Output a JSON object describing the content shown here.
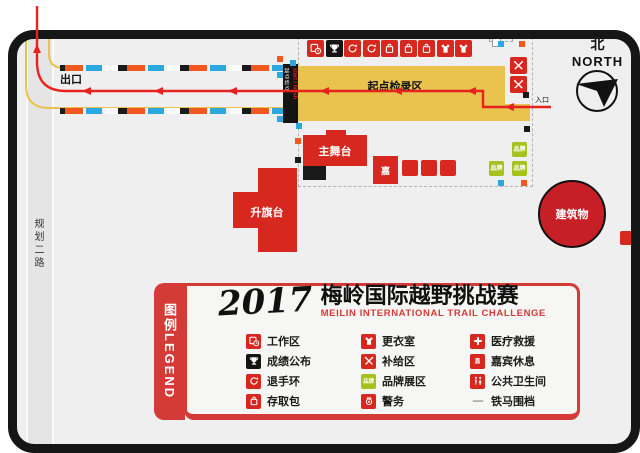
{
  "colors": {
    "red": "#d6281e",
    "legend_red": "#d43b36",
    "yellow": "#e9c34d",
    "green": "#a5c21f",
    "blue": "#2aa8df",
    "orange": "#f0581f",
    "black": "#141414",
    "route_red": "#e8231f",
    "bg": "#efefef"
  },
  "map": {
    "north": {
      "cn": "北",
      "en": "NORTH"
    },
    "exit_label": "出口",
    "entrance_label": "入口",
    "road_label": "规划二路",
    "checkin_area_label": "起点检录区",
    "banner": {
      "cn": "起点终点",
      "en": "start / finish"
    },
    "main_stage_label": "主舞台",
    "flag_platform_label": "升旗台",
    "building_label": "建筑物",
    "guest_box_label": "嘉",
    "brand_box_label": "品牌",
    "icon_row": [
      {
        "name": "workzone-icon",
        "bg": "#d6281e"
      },
      {
        "name": "trophy-icon",
        "bg": "#141414"
      },
      {
        "name": "bracelet-icon",
        "bg": "#d6281e"
      },
      {
        "name": "bracelet-icon",
        "bg": "#d6281e"
      },
      {
        "name": "bag-icon",
        "bg": "#d6281e"
      },
      {
        "name": "bag-icon",
        "bg": "#d6281e"
      },
      {
        "name": "bag-icon",
        "bg": "#d6281e"
      },
      {
        "name": "shirt-icon",
        "bg": "#d6281e"
      },
      {
        "name": "shirt-icon",
        "bg": "#d6281e"
      }
    ]
  },
  "legend": {
    "tab": {
      "cn": "图例",
      "en": "LEGEND"
    },
    "title": {
      "year": "2017",
      "cn": "梅岭国际越野挑战赛",
      "en": "MEILIN INTERNATIONAL TRAIL CHALLENGE"
    },
    "columns": [
      [
        {
          "label": "工作区",
          "icon": "workzone-icon",
          "bg": "#d6281e"
        },
        {
          "label": "成绩公布",
          "icon": "trophy-icon",
          "bg": "#141414"
        },
        {
          "label": "退手环",
          "icon": "bracelet-icon",
          "bg": "#d6281e"
        },
        {
          "label": "存取包",
          "icon": "bag-icon",
          "bg": "#d6281e"
        }
      ],
      [
        {
          "label": "更衣室",
          "icon": "shirt-icon",
          "bg": "#d6281e"
        },
        {
          "label": "补给区",
          "icon": "cutlery-icon",
          "bg": "#d6281e"
        },
        {
          "label": "品牌展区",
          "icon": "brand-icon",
          "bg": "#a5c21f",
          "text": "品牌"
        },
        {
          "label": "警务",
          "icon": "police-icon",
          "bg": "#d6281e"
        }
      ],
      [
        {
          "label": "医疗救援",
          "icon": "medical-icon",
          "bg": "#d6281e"
        },
        {
          "label": "嘉宾休息",
          "icon": "guest-icon",
          "bg": "#d6281e",
          "text": "嘉"
        },
        {
          "label": "公共卫生间",
          "icon": "toilet-icon",
          "bg": "#d6281e"
        },
        {
          "label": "铁马围档",
          "icon": "barrier-icon",
          "bg": "none"
        }
      ]
    ]
  }
}
